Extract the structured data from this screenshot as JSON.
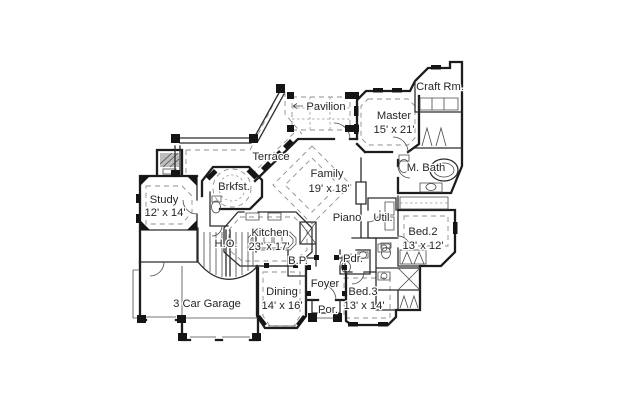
{
  "page": {
    "background": "#ffffff",
    "ink": "#1d1d1d",
    "dash_color": "#8f8f8f",
    "hatch_fill": "#bdbdbd"
  },
  "floorplan": {
    "rooms": [
      {
        "name": "Pavilion",
        "dims": ""
      },
      {
        "name": "Craft Rm.",
        "dims": ""
      },
      {
        "name": "Master",
        "dims": "15' x 21'"
      },
      {
        "name": "Terrace",
        "dims": ""
      },
      {
        "name": "Family",
        "dims": "19' x 18'"
      },
      {
        "name": "M. Bath",
        "dims": ""
      },
      {
        "name": "Brkfst.",
        "dims": ""
      },
      {
        "name": "Study",
        "dims": "12' x 14'"
      },
      {
        "name": "Piano",
        "dims": ""
      },
      {
        "name": "Util.",
        "dims": ""
      },
      {
        "name": "Kitchen",
        "dims": "23' x 17'"
      },
      {
        "name": "Bed.2",
        "dims": "13' x 12'"
      },
      {
        "name": "H.O.",
        "dims": ""
      },
      {
        "name": "B.P.",
        "dims": ""
      },
      {
        "name": "Pdr.",
        "dims": ""
      },
      {
        "name": "Foyer",
        "dims": ""
      },
      {
        "name": "Dining",
        "dims": "14' x 16'"
      },
      {
        "name": "Bed.3",
        "dims": "13' x 14'"
      },
      {
        "name": "Por.",
        "dims": ""
      },
      {
        "name": "3 Car Garage",
        "dims": ""
      }
    ]
  }
}
